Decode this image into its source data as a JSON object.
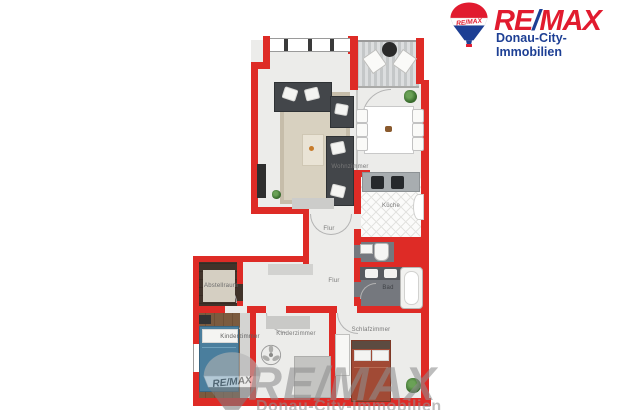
{
  "logo": {
    "balloon_text": "RE/MAX",
    "brand_re": "RE",
    "brand_slash": "/",
    "brand_max": "MAX",
    "subtitle": "Donau-City-Immobilien"
  },
  "floorplan": {
    "wall_color": "#de2b26",
    "rooms": [
      {
        "id": "wohnzimmer",
        "label": "Wohnzimmer"
      },
      {
        "id": "kueche",
        "label": "Küche"
      },
      {
        "id": "flur-oben",
        "label": "Flur"
      },
      {
        "id": "flur-unten",
        "label": "Flur"
      },
      {
        "id": "bad",
        "label": "Bad"
      },
      {
        "id": "abstellraum",
        "label": "Abstellraum"
      },
      {
        "id": "kinderzimmer-links",
        "label": "Kinderzimmer"
      },
      {
        "id": "kinderzimmer-mitte",
        "label": "Kinderzimmer"
      },
      {
        "id": "schlafzimmer",
        "label": "Schlafzimmer"
      }
    ]
  },
  "watermark": {
    "balloon_text": "RE/MAX",
    "brand": "RE/MAX",
    "subtitle": "Donau-City-Immobilien"
  }
}
